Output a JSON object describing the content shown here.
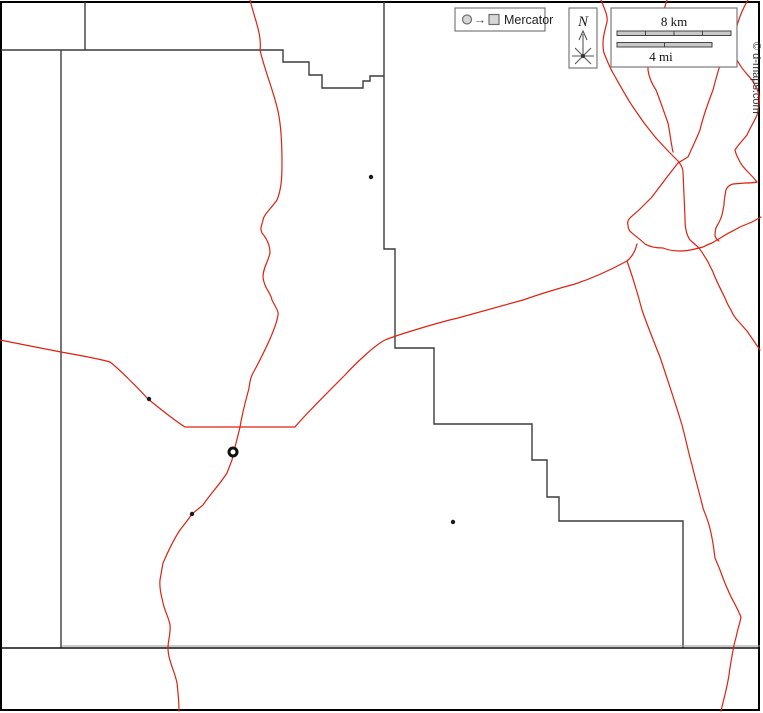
{
  "legend": {
    "projection_label": "Mercator",
    "circle_icon": "circle-symbol",
    "square_icon": "square-symbol",
    "arrow_glyph": "→"
  },
  "compass": {
    "north_label": "N"
  },
  "scalebar": {
    "km_label": "8 km",
    "mi_label": "4 mi"
  },
  "copyright": {
    "text": "© d-maps.com"
  },
  "colors": {
    "frame": "#000000",
    "boundary": "#3c3c3c",
    "boundary_light": "#9a9a9a",
    "road": "#dd2211",
    "box_border": "#7a7a7a",
    "bar_fill": "#c9c9c9",
    "bar_border": "#444444",
    "icon_fill": "#d6d6d6",
    "icon_border": "#6e6e6e",
    "text_dark": "#222222",
    "copyright_color": "#333333"
  },
  "map": {
    "boundaries": {
      "top_left_vertical": "M85,2 L85,50",
      "top_step": "M1,50 L283,50 L283,62 L309,62 L309,75 L322,75 L322,88 L363,88 L363,81 L370,81 L370,76 L384,76",
      "main_stair": "M384,2 L384,249 L395,249 L395,348 L434,348 L434,424 L532,424 L532,460 L547,460 L547,497 L559,497 L559,521 L683,521 L683,648",
      "west_vertical": "M61,50 L61,648",
      "south_line": "M1,648 L760,648",
      "south_line_light": "M62,646 L760,646"
    },
    "roads": {
      "river_west": "M250,0 C255,20 262,35 260,50 C264,68 273,90 277,107 C281,122 282,140 282,163 C282,180 281,190 277,200 C270,210 264,214 263,220 C261,228 260,228 262,233 C268,240 270,246 270,253 C268,262 263,268 263,277 C264,288 271,293 272,300 C276,308 279,312 278,315 C276,330 259,362 252,375 C249,382 250,386 248,392 C245,403 242,415 240,427 C237,440 234,450 232,460 L227,473 C220,484 208,497 203,505 L192,514 C188,520 183,526 180,530 C172,542 168,552 163,563 L160,580 C159,590 162,597 163,603 C165,612 169,618 170,625 C171,633 168,640 168,648 C168,660 175,672 177,683 C178,692 179,700 179,711",
      "road_southwest": "M0,340 C20,344 45,349 61,352 C78,355 100,359 110,362 C118,368 138,388 148,399 C158,407 175,421 185,427 L240,427 L295,427 C303,417 332,388 345,375 C355,364 375,345 385,340 C397,335 440,322 458,318 L523,300 C543,293 560,288 575,284 C590,279 605,273 627,261 C632,257 635,252 637,244",
      "road_south_branch": "M627,261 C632,275 638,295 642,310 C646,322 654,342 660,357 C667,378 676,405 682,425 C686,440 689,455 692,465 C695,478 700,495 703,508 C706,517 711,524 715,558 L720,570 C723,578 725,584 728,590 C731,598 736,605 741,617 C740,623 738,628 737,633 C736,638 735,641 734,645 C732,656 730,666 729,675 C727,688 724,698 721,711",
      "road_ne_1": "M601,0 C605,10 608,16 607,22 C605,30 603,36 603,43 C603,48 603,50 604,53 C606,58 610,68 613,73 C617,80 628,100 633,107 L642,120 C647,127 652,133 656,138 L669,152 L678,161 C681,165 683,168 683,172 L684,195 L685,218 C685,222 685,226 686,230 C687,235 688,237 690,240 L698,247 C701,250 705,257 708,262 L713,272 C715,278 722,292 725,298 C727,303 729,307 731,310 C733,315 736,319 739,322 C742,325 744,328 747,331 L760,350",
      "road_ne_1b": "M667,0 C664,10 660,20 660,27 C656,38 652,45 650,52 C648,58 648,64 648,70 C649,78 652,84 656,90 C660,100 664,112 668,123 C670,133 671,143 673,152",
      "road_ne_2": "M733,8 C729,20 727,30 726,40 C723,50 721,57 720,65 C717,75 715,82 713,90 C708,103 703,117 700,130 C696,140 691,150 688,157 L678,163 C674,168 671,172 667,177 C662,184 657,190 652,197 C649,200 646,203 641,208 C637,212 633,215 630,218 C628,220 627,222 628,225 C628,228 629,231 632,233 C635,236 639,238 645,244 C650,247 656,248 663,248 C668,250 675,251 680,251 C686,251 691,250 695,249 L703,247 C707,245 709,244 712,243 L722,237 C728,233 735,230 740,227 L752,222 L761,217",
      "road_ne_3": "M748,0 C743,8 738,20 736,30 C734,36 733,41 733,47 C733,54 736,59 740,65 C743,70 747,74 752,80 C755,85 758,90 759,95 C760,102 759,108 757,115 C754,122 750,128 747,135 C743,140 738,145 735,150 C736,155 738,158 740,162 C742,166 745,169 748,172 C751,175 754,178 757,182 C753,183 749,183 745,183 L733,184 C729,185 727,187 726,190 C725,195 724,200 724,205 L722,215 C720,222 717,225 716,228 C715,231 715,233 715,236 C716,239 717,240 719,241"
    },
    "towns": [
      {
        "x": 371,
        "y": 177
      },
      {
        "x": 149,
        "y": 399
      },
      {
        "x": 192,
        "y": 514
      },
      {
        "x": 453,
        "y": 522
      }
    ],
    "city_ring": {
      "x": 233,
      "y": 452
    }
  }
}
